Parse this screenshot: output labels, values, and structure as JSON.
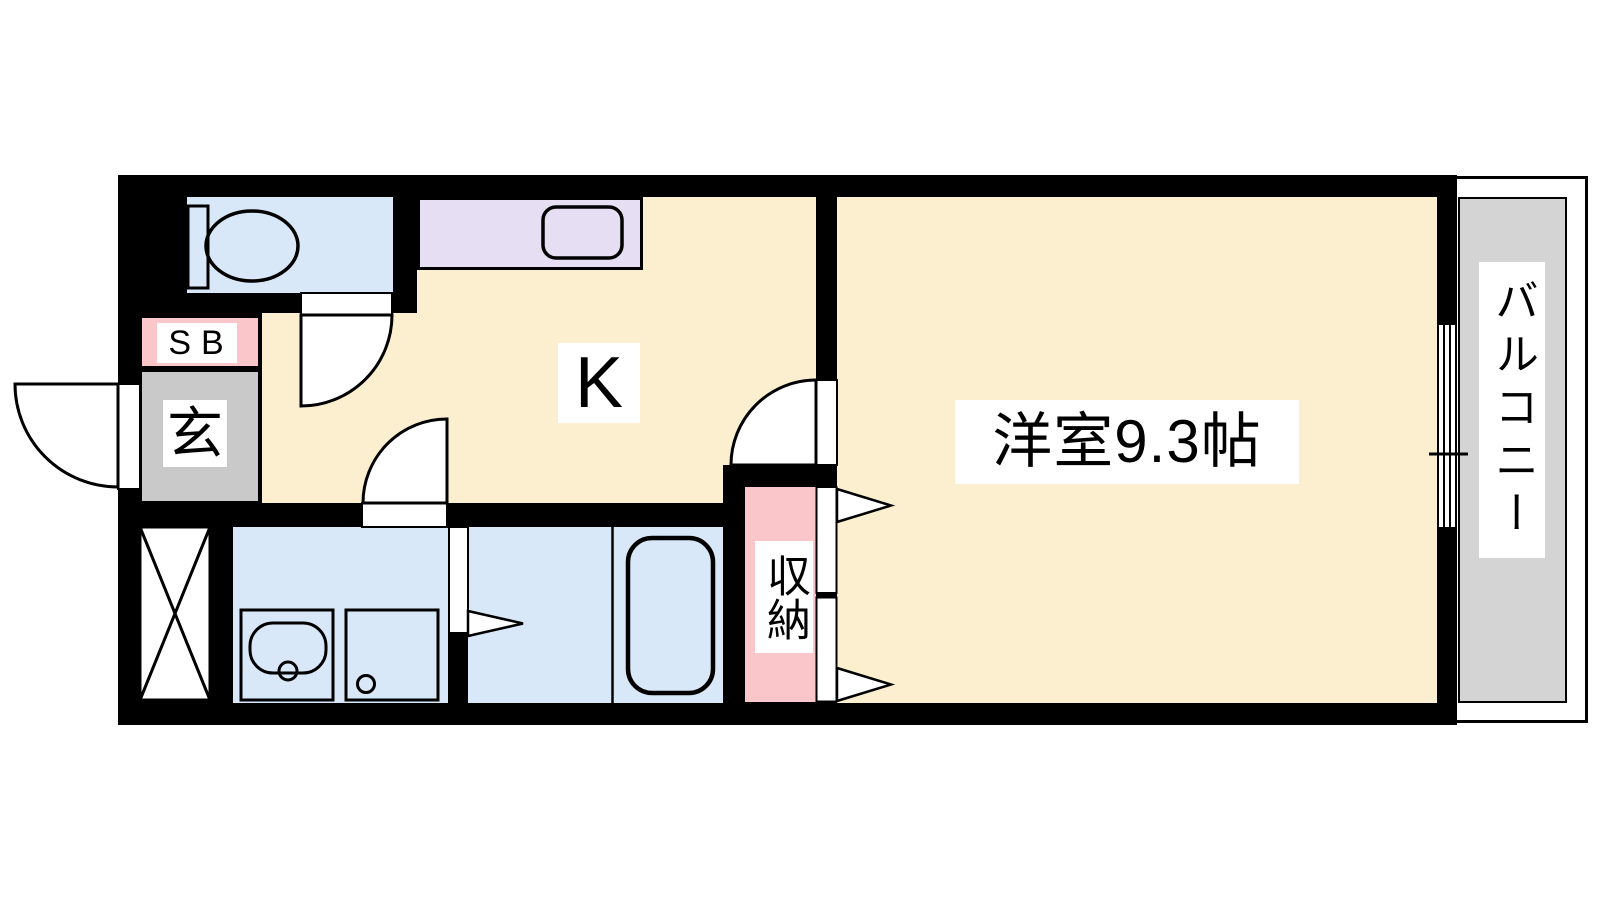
{
  "plan": {
    "type": "apartment-floor-plan",
    "labels": {
      "kitchen": "K",
      "western_room": "洋室9.3帖",
      "entrance": "玄",
      "shoe_box": "SB",
      "storage": "収納",
      "balcony": "バルコニー"
    },
    "colors": {
      "wall": "#000000",
      "floor_cream": "#FBEFD0",
      "wet_blue": "#D9E8F9",
      "counter_purple": "#E6DFF3",
      "pink": "#FAC6CA",
      "entry_gray": "#C9C9C9",
      "balcony_gray": "#D4D4D4",
      "white": "#FFFFFF"
    }
  }
}
